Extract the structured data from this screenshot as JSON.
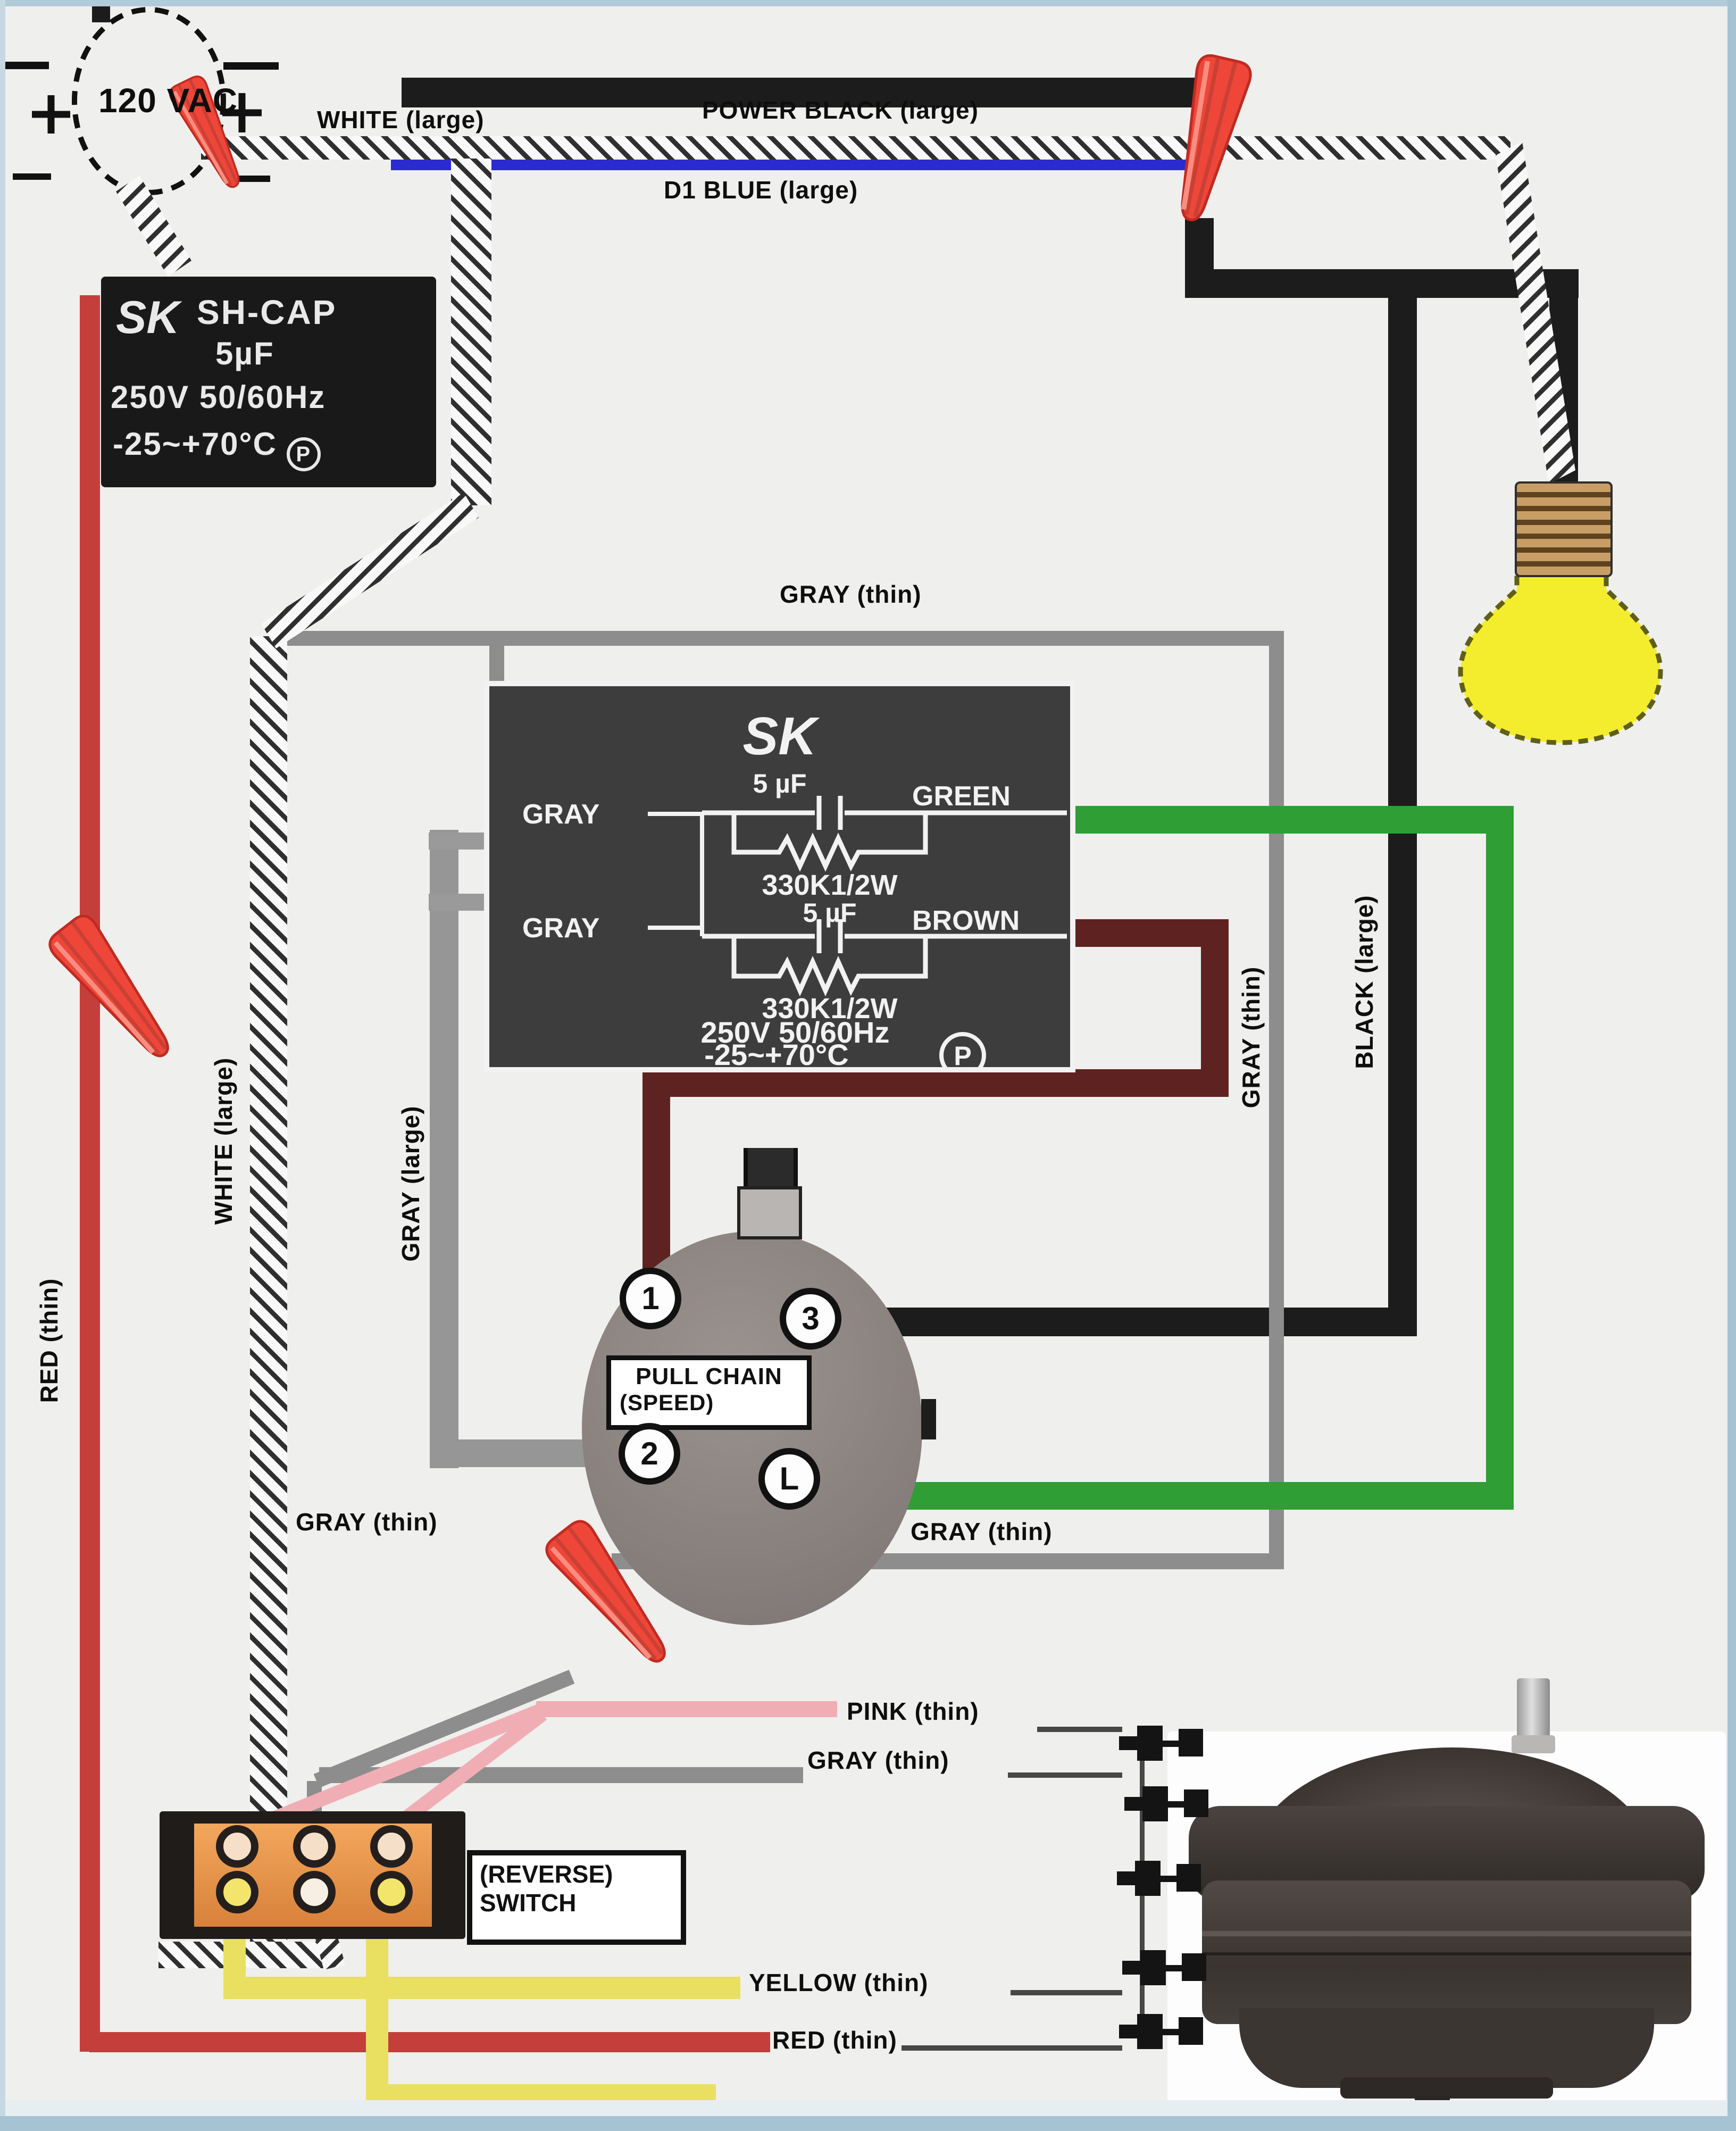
{
  "source": {
    "label": "120 VAC"
  },
  "labels": {
    "power_black": "POWER BLACK (large)",
    "d1_blue": "D1 BLUE (large)",
    "white_top": "WHITE (large)",
    "gray_thin_top": "GRAY (thin)",
    "white_large_left": "WHITE (large)",
    "gray_large_left": "GRAY (large)",
    "red_thin_left": "RED (thin)",
    "gray_thin_right": "GRAY (thin)",
    "black_large_right": "BLACK (large)",
    "gray_thin_bottom_left": "GRAY (thin)",
    "gray_thin_bottom_right": "GRAY (thin)",
    "pink_thin": "PINK (thin)",
    "gray_thin_center": "GRAY (thin)",
    "yellow_thin": "YELLOW (thin)",
    "red_thin_bottom": "RED (thin)"
  },
  "sh_cap": {
    "logo": "SK",
    "name": "SH-CAP",
    "value": "5µF",
    "rating": "250V 50/60Hz",
    "temp": "-25~+70°C",
    "mark": "P"
  },
  "fan_cap": {
    "logo": "SK",
    "cap1": "5 µF",
    "green": "GREEN",
    "gray1": "GRAY",
    "res1": "330K1/2W",
    "gray2": "GRAY",
    "cap2": "5 µF",
    "brown": "BROWN",
    "res2": "330K1/2W",
    "rating": "250V 50/60Hz",
    "temp": "-25~+70°C",
    "mark": "P"
  },
  "pull_chain_switch": {
    "line1": "PULL CHAIN",
    "line2": "(SPEED)",
    "t1": "1",
    "t2": "2",
    "t3": "3",
    "tL": "L"
  },
  "reverse_switch": {
    "line1": "(REVERSE)",
    "line2": "SWITCH"
  },
  "colors": {
    "background": "#efefed",
    "black_wire": "#1c1c1c",
    "blue_wire": "#2b2bcf",
    "gray_thin_wire": "#8d8d8d",
    "gray_large_wire": "#969696",
    "green_wire": "#2f9e35",
    "brown_wire": "#5e2220",
    "red_wire": "#c43f3c",
    "pink_wire": "#f0aeb4",
    "yellow_wire": "#e9e062",
    "wire_nut": "#ee4639",
    "reverse_switch_inner": "#ef9e54",
    "switch_body": "#8d8583",
    "bulb": "#f3ed2d"
  }
}
